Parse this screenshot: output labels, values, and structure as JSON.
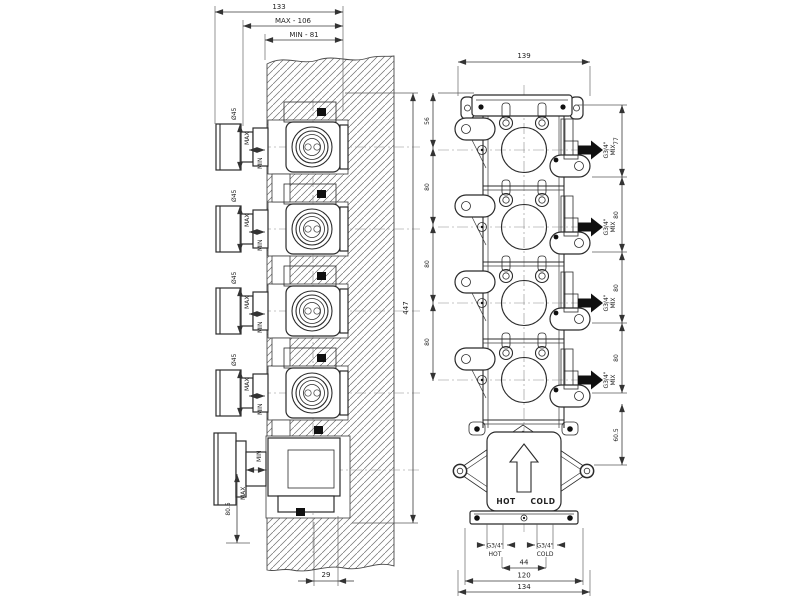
{
  "drawing": {
    "left_view": {
      "dims": {
        "overall_depth": "133",
        "max_depth": "MAX - 106",
        "min_depth": "MIN - 81",
        "overall_height": "447",
        "bottom_inset": "29",
        "bottom_offset": "80.5"
      },
      "units": [
        {
          "diameter": "Ø45",
          "max": "MAX",
          "min": "MIN"
        },
        {
          "diameter": "Ø45",
          "max": "MAX",
          "min": "MIN"
        },
        {
          "diameter": "Ø45",
          "max": "MAX",
          "min": "MIN"
        },
        {
          "diameter": "Ø45",
          "max": "MAX",
          "min": "MIN"
        }
      ],
      "volume_unit": {
        "max": "MAX",
        "min": "MIN"
      }
    },
    "right_view": {
      "dims": {
        "overall_width": "139",
        "top_spacing": "56",
        "spacing_1": "80",
        "spacing_2": "80",
        "spacing_3": "80",
        "outlet_top": "77",
        "outlet_1": "80",
        "outlet_2": "80",
        "outlet_3": "80",
        "bottom_spacing": "60.5",
        "inlet_spacing": "44",
        "rail_width": "120",
        "overall_base_width": "134"
      },
      "outlets": [
        {
          "thread": "G3/4\"",
          "flow": "MIX"
        },
        {
          "thread": "G3/4\"",
          "flow": "MIX"
        },
        {
          "thread": "G3/4\"",
          "flow": "MIX"
        },
        {
          "thread": "G3/4\"",
          "flow": "MIX"
        }
      ],
      "inlet_box": {
        "hot": "HOT",
        "cold": "COLD"
      },
      "inlets": [
        {
          "thread": "G3/4\"",
          "flow": "HOT"
        },
        {
          "thread": "G3/4\"",
          "flow": "COLD"
        }
      ]
    }
  }
}
